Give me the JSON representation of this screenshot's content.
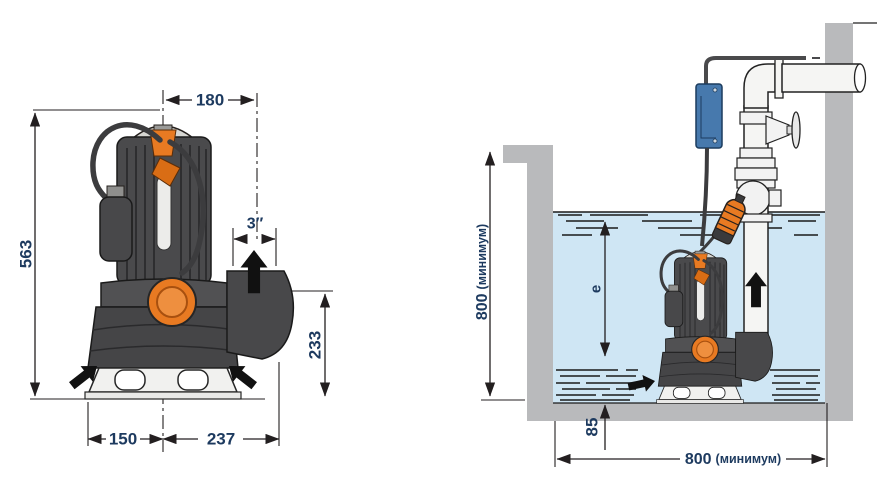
{
  "drawing": {
    "left": {
      "overall_height": "563",
      "top_width": "180",
      "discharge_size": "3″",
      "discharge_height": "233",
      "base_left": "150",
      "base_right": "237"
    },
    "right": {
      "depth_value": "800",
      "depth_qualifier": "(минимум)",
      "width_value": "800",
      "width_qualifier": "(минимум)",
      "min_level": "85",
      "submergence": "e"
    }
  },
  "colors": {
    "dim_text": "#1d3a5f",
    "line": "#231f20",
    "pump_orange": "#e87a22",
    "water_blue": "#cfe6f4",
    "wall_gray": "#b9babc",
    "control_box_blue": "#4779ad"
  }
}
